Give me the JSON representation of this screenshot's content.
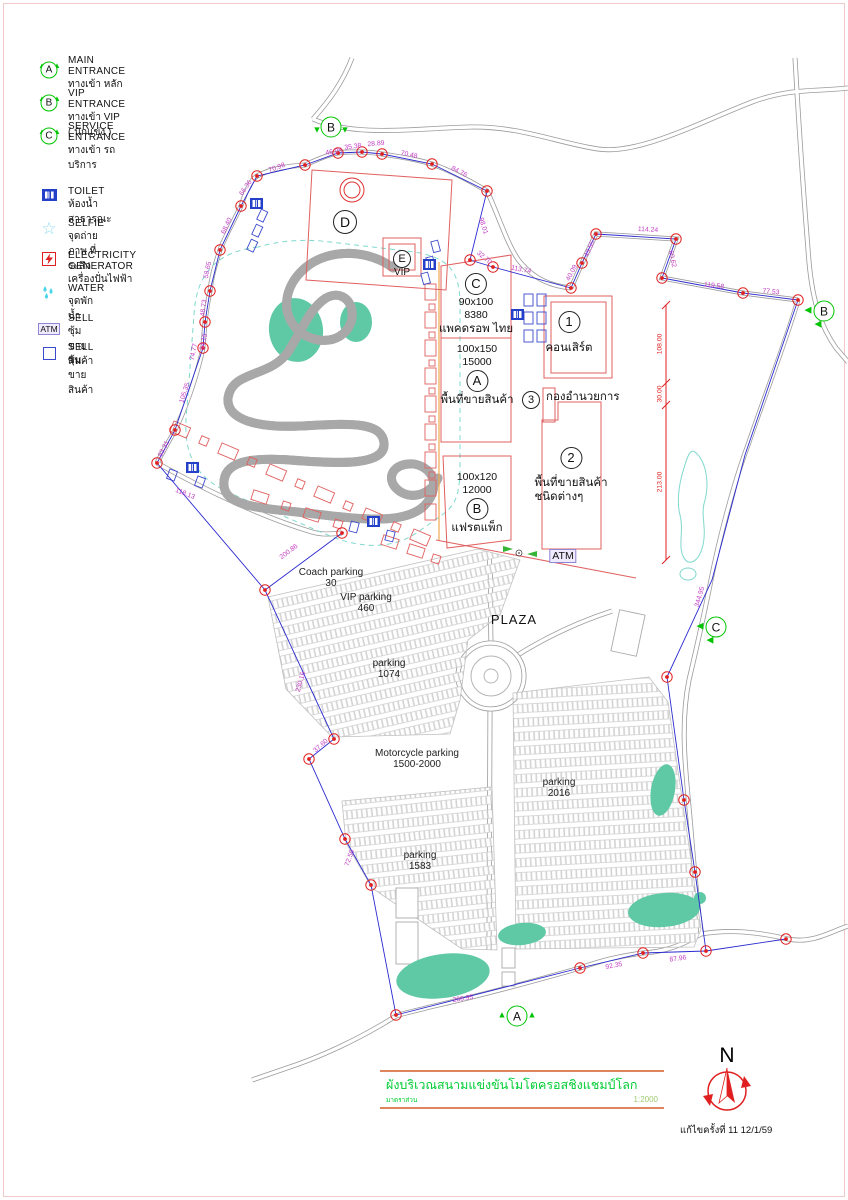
{
  "colors": {
    "boundary_blue": "#2a2ad0",
    "survey_point_red": "#e02020",
    "dimension_magenta": "#c23cc2",
    "building_red": "#e06060",
    "entrance_green": "#00c400",
    "pond_teal": "#5fc9a6",
    "title_green": "#00cc33",
    "booth_blue": "#3b49cc",
    "vendor_orange": "#f0a850"
  },
  "legend": {
    "entrances": [
      {
        "id": "A",
        "en": "MAIN  ENTRANCE",
        "th": "ทางเข้า หลัก"
      },
      {
        "id": "B",
        "en": "VIP  ENTRANCE",
        "th": "ทางเข้า VIP ( นักแข่ง )"
      },
      {
        "id": "C",
        "en": "SERVICE  ENTRANCE",
        "th": "ทางเข้า รถบริการ"
      }
    ],
    "symbols": [
      {
        "icon": "toilet-icon",
        "en": "TOILET",
        "th": "ห้องน้ำ สาธารณะ"
      },
      {
        "icon": "selfie-icon",
        "en": "SELFIE",
        "th": "จุดถ่ายภาพ ที่ระลึก"
      },
      {
        "icon": "electricity-generator-icon",
        "en": "ELECTRICITY   GENERATOR",
        "th": "เครื่องปั่นไฟฟ้า"
      },
      {
        "icon": "water-icon",
        "en": "WATER",
        "th": "จุดพักน้ำ"
      },
      {
        "icon": "atm-booth-icon",
        "badge": "ATM",
        "en": "SELL",
        "th": "ซุ้มขายสินค้า"
      },
      {
        "icon": "sell-booth-icon",
        "en": "SELL",
        "th": "ซุ้มขายสินค้า"
      }
    ]
  },
  "map": {
    "zones": {
      "d_label": "D",
      "e_label": "E",
      "e_sub": "VIP",
      "c_zone": {
        "id": "C",
        "size": "90x100",
        "capacity": "8380",
        "name": "แพคดรอพ ไทย"
      },
      "a_zone": {
        "id": "A",
        "size": "100x150",
        "capacity": "15000",
        "name": "พื้นที่ขายสินค้า"
      },
      "b_zone": {
        "id": "B",
        "size": "100x120",
        "capacity": "12000",
        "name": "แฟรตแพ็ก"
      },
      "zone1": {
        "id": "1",
        "name": "คอนเสิร์ต"
      },
      "zone2": {
        "id": "2",
        "name_line1": "พื้นที่ขายสินค้า",
        "name_line2": "ชนิดต่างๆ"
      },
      "zone3": {
        "id": "3",
        "name": "กองอำนวยการ"
      },
      "plaza": "PLAZA",
      "atm": "ATM"
    },
    "parking_labels": [
      {
        "line1": "Coach parking",
        "line2": "30",
        "x": 331,
        "y": 567
      },
      {
        "line1": "VIP parking",
        "line2": "460",
        "x": 366,
        "y": 592
      },
      {
        "line1": "parking",
        "line2": "1074",
        "x": 389,
        "y": 658
      },
      {
        "line1": "Motorcycle parking",
        "line2": "1500-2000",
        "x": 417,
        "y": 748
      },
      {
        "line1": "parking",
        "line2": "2016",
        "x": 559,
        "y": 777
      },
      {
        "line1": "parking",
        "line2": "1583",
        "x": 420,
        "y": 850
      }
    ],
    "entrance_markers": [
      {
        "id": "B",
        "x": 331,
        "y": 127,
        "dir": "down"
      },
      {
        "id": "B",
        "x": 824,
        "y": 311,
        "dir": "left"
      },
      {
        "id": "C",
        "x": 716,
        "y": 627,
        "dir": "left"
      },
      {
        "id": "A",
        "x": 517,
        "y": 1016,
        "dir": "up"
      }
    ],
    "dimensions": [
      {
        "t": "70.98",
        "x": 277,
        "y": 168,
        "r": -20
      },
      {
        "t": "46.05",
        "x": 334,
        "y": 152,
        "r": -10
      },
      {
        "t": "35.38",
        "x": 353,
        "y": 147,
        "r": -8
      },
      {
        "t": "28.89",
        "x": 376,
        "y": 144,
        "r": -5
      },
      {
        "t": "70.48",
        "x": 409,
        "y": 155,
        "r": 12
      },
      {
        "t": "84.76",
        "x": 459,
        "y": 172,
        "r": 28
      },
      {
        "t": "98.01",
        "x": 483,
        "y": 226,
        "r": 72
      },
      {
        "t": "32.70",
        "x": 484,
        "y": 258,
        "r": 40
      },
      {
        "t": "66.36",
        "x": 246,
        "y": 188,
        "r": -55
      },
      {
        "t": "68.40",
        "x": 227,
        "y": 226,
        "r": -65
      },
      {
        "t": "58.65",
        "x": 208,
        "y": 270,
        "r": -78
      },
      {
        "t": "48.73",
        "x": 204,
        "y": 308,
        "r": -83
      },
      {
        "t": "34.15",
        "x": 204,
        "y": 342,
        "r": -78
      },
      {
        "t": "74.77",
        "x": 194,
        "y": 352,
        "r": -78
      },
      {
        "t": "105.35",
        "x": 185,
        "y": 393,
        "r": -72
      },
      {
        "t": "83.31",
        "x": 164,
        "y": 449,
        "r": -62
      },
      {
        "t": "118.13",
        "x": 185,
        "y": 494,
        "r": 22
      },
      {
        "t": "114.24",
        "x": 648,
        "y": 230,
        "r": 3
      },
      {
        "t": "43.55",
        "x": 590,
        "y": 249,
        "r": -66
      },
      {
        "t": "40.09",
        "x": 572,
        "y": 273,
        "r": -62
      },
      {
        "t": "60.62",
        "x": 672,
        "y": 259,
        "r": 78
      },
      {
        "t": "113.74",
        "x": 521,
        "y": 270,
        "r": 11
      },
      {
        "t": "119.58",
        "x": 714,
        "y": 286,
        "r": 7
      },
      {
        "t": "77.53",
        "x": 771,
        "y": 292,
        "r": 6
      },
      {
        "t": "108.00",
        "x": 660,
        "y": 344,
        "r": -90,
        "red": true
      },
      {
        "t": "30.00",
        "x": 660,
        "y": 394,
        "r": -90,
        "red": true
      },
      {
        "t": "213.00",
        "x": 660,
        "y": 482,
        "r": -90,
        "red": true
      },
      {
        "t": "344.95",
        "x": 700,
        "y": 597,
        "r": -74
      },
      {
        "t": "200.86",
        "x": 289,
        "y": 552,
        "r": -37
      },
      {
        "t": "230.16",
        "x": 301,
        "y": 682,
        "r": -74
      },
      {
        "t": "37.60",
        "x": 321,
        "y": 746,
        "r": -42
      },
      {
        "t": "72.50",
        "x": 350,
        "y": 858,
        "r": -70
      },
      {
        "t": "266.95",
        "x": 463,
        "y": 999,
        "r": -9
      },
      {
        "t": "92.35",
        "x": 614,
        "y": 966,
        "r": -11
      },
      {
        "t": "87.96",
        "x": 678,
        "y": 959,
        "r": -8
      }
    ]
  },
  "title_block": {
    "title": "ผังบริเวณสนามแข่งขันโมโตครอสชิงแชมป์โลก",
    "scale_label": "มาตราส่วน",
    "scale_value": "1:2000"
  },
  "footer": {
    "revision": "แก้ไขครั้งที่ 11   12/1/59"
  },
  "compass": {
    "label": "N"
  }
}
